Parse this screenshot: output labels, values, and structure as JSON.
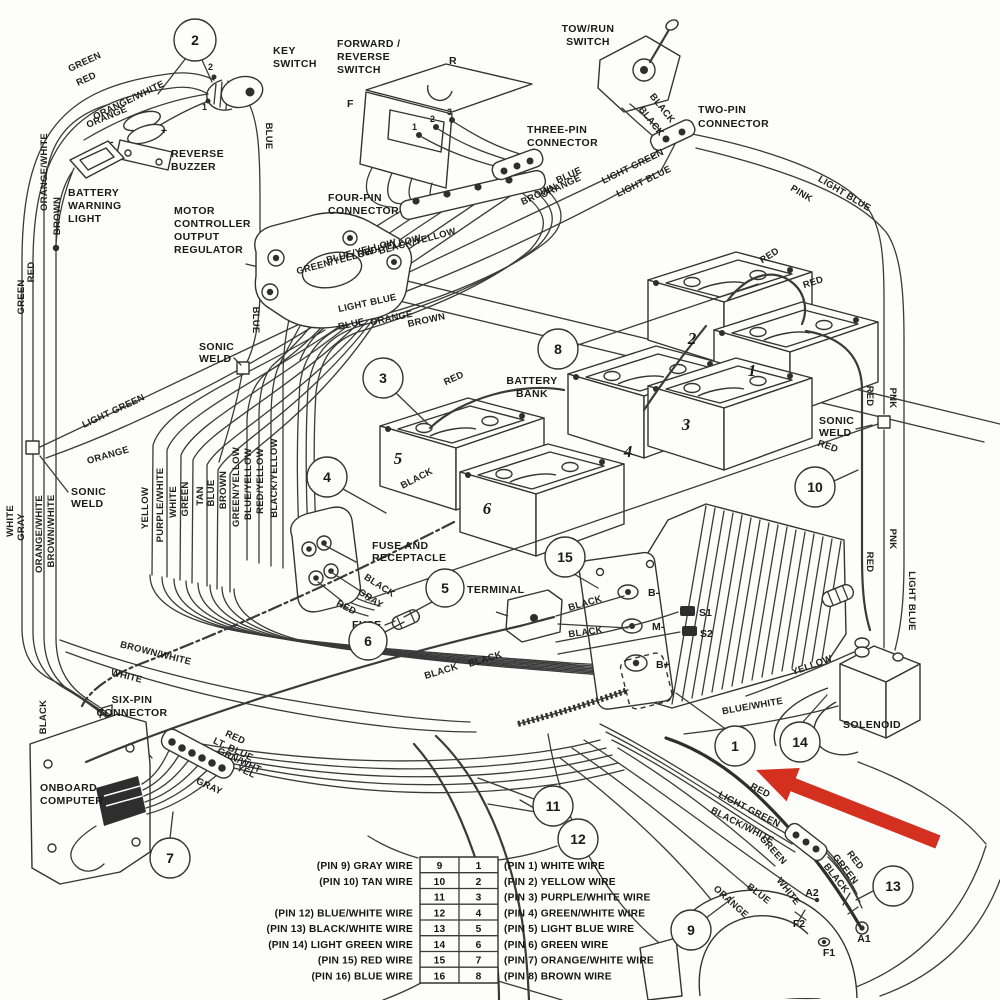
{
  "colors": {
    "ink": "#3a3a3a",
    "background": "#fdfdfc",
    "arrow_red": "#d4301f"
  },
  "components": {
    "key_switch": [
      "KEY",
      "SWITCH"
    ],
    "forward_reverse_switch": [
      "FORWARD /",
      "REVERSE",
      "SWITCH"
    ],
    "tow_run_switch": [
      "TOW/RUN",
      "SWITCH"
    ],
    "two_pin_connector": [
      "TWO-PIN",
      "CONNECTOR"
    ],
    "three_pin_connector": [
      "THREE-PIN",
      "CONNECTOR"
    ],
    "four_pin_connector": [
      "FOUR-PIN",
      "CONNECTOR"
    ],
    "six_pin_connector": [
      "SIX-PIN",
      "CONNECTOR"
    ],
    "reverse_buzzer": [
      "REVERSE",
      "BUZZER"
    ],
    "battery_warning_light": [
      "BATTERY",
      "WARNING",
      "LIGHT"
    ],
    "motor_controller_output_regulator": [
      "MOTOR",
      "CONTROLLER",
      "OUTPUT",
      "REGULATOR"
    ],
    "battery_bank": [
      "BATTERY",
      "BANK"
    ],
    "sonic_weld": [
      "SONIC",
      "WELD"
    ],
    "fuse_and_receptacle": [
      "FUSE AND",
      "RECEPTACLE"
    ],
    "terminal": "TERMINAL",
    "fuse": "FUSE",
    "onboard_computer": [
      "ONBOARD",
      "COMPUTER"
    ],
    "solenoid": "SOLENOID"
  },
  "callouts": {
    "c1": "1",
    "c2": "2",
    "c3": "3",
    "c4": "4",
    "c5": "5",
    "c6": "6",
    "c7": "7",
    "c8": "8",
    "c9": "9",
    "c10": "10",
    "c11": "11",
    "c12": "12",
    "c13": "13",
    "c14": "14",
    "c15": "15"
  },
  "battery_numbers": [
    "1",
    "2",
    "3",
    "4",
    "5",
    "6"
  ],
  "controller_terminals": {
    "b_minus": "B-",
    "m_minus": "M-",
    "b_plus": "B+",
    "s1": "S1",
    "s2": "S2"
  },
  "motor_terminals": {
    "a1": "A1",
    "a2": "A2",
    "f1": "F1",
    "f2": "F2"
  },
  "switch_marks": {
    "f": "F",
    "r": "R",
    "pin1": "1",
    "pin2": "2",
    "pin3": "3",
    "key1": "1",
    "key2": "2",
    "plus": "+",
    "minus": "-"
  },
  "wire_colors": {
    "green": "GREEN",
    "red": "RED",
    "orange_white": "ORANGE/WHITE",
    "brown": "BROWN",
    "blue": "BLUE",
    "black": "BLACK",
    "white": "WHITE",
    "gray": "GRAY",
    "orange": "ORANGE",
    "yellow": "YELLOW",
    "tan": "TAN",
    "pink": "PINK",
    "pnk": "PNK",
    "light_green": "LIGHT GREEN",
    "light_blue": "LIGHT BLUE",
    "purple_white": "PURPLE/WHITE",
    "brown_white": "BROWN/WHITE",
    "green_yellow": "GREEN/YELLOW",
    "blue_yellow": "BLUE/YELLOW",
    "red_yellow": "RED/YELLOW",
    "black_yellow": "BLACK/YELLOW",
    "blue_white": "BLUE/WHITE",
    "black_white": "BLACK/WHITE",
    "lt_blue": "LT. BLUE",
    "grn_wht": "GRN/WHT",
    "yel": "YEL"
  },
  "pin_table": {
    "rows": [
      {
        "left_label": "(PIN 9) GRAY WIRE",
        "left_num": "9",
        "right_num": "1",
        "right_label": "(PIN 1) WHITE WIRE"
      },
      {
        "left_label": "(PIN 10) TAN WIRE",
        "left_num": "10",
        "right_num": "2",
        "right_label": "(PIN 2) YELLOW WIRE"
      },
      {
        "left_label": "",
        "left_num": "11",
        "right_num": "3",
        "right_label": "(PIN 3) PURPLE/WHITE WIRE"
      },
      {
        "left_label": "(PIN 12) BLUE/WHITE WIRE",
        "left_num": "12",
        "right_num": "4",
        "right_label": "(PIN 4) GREEN/WHITE WIRE"
      },
      {
        "left_label": "(PIN 13) BLACK/WHITE WIRE",
        "left_num": "13",
        "right_num": "5",
        "right_label": "(PIN 5) LIGHT BLUE WIRE"
      },
      {
        "left_label": "(PIN 14) LIGHT GREEN WIRE",
        "left_num": "14",
        "right_num": "6",
        "right_label": "(PIN 6) GREEN WIRE"
      },
      {
        "left_label": "(PIN 15) RED WIRE",
        "left_num": "15",
        "right_num": "7",
        "right_label": "(PIN 7) ORANGE/WHITE WIRE"
      },
      {
        "left_label": "(PIN 16) BLUE WIRE",
        "left_num": "16",
        "right_num": "8",
        "right_label": "(PIN 8) BROWN WIRE"
      }
    ]
  }
}
